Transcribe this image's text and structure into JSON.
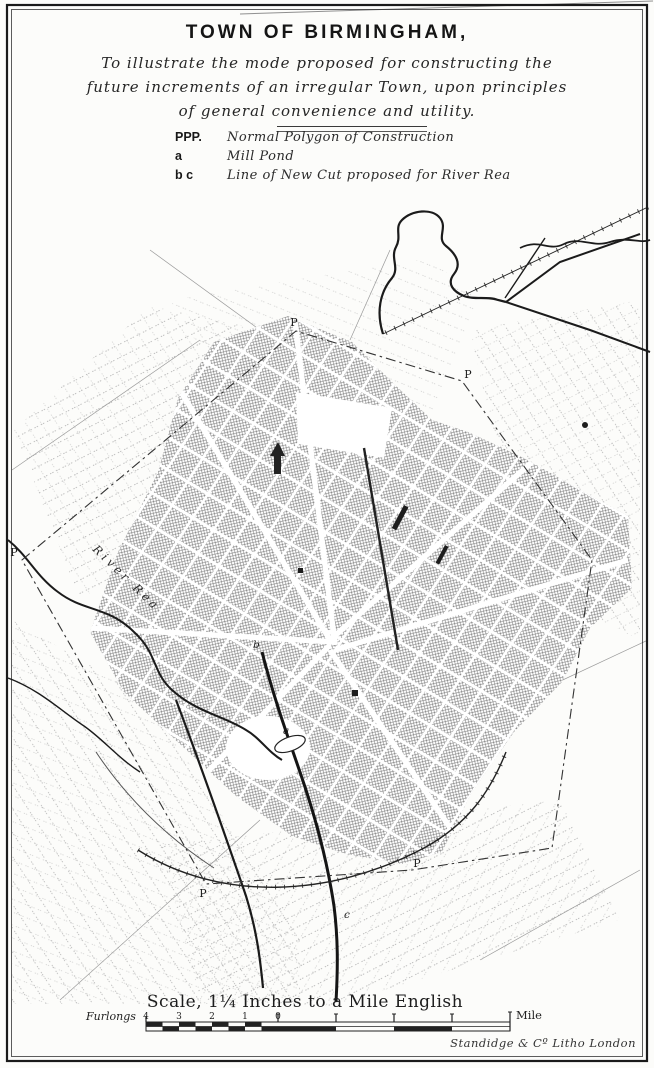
{
  "title_block": {
    "title": "TOWN OF BIRMINGHAM,",
    "subtitle_lines": [
      "To illustrate the mode proposed for constructing the",
      "future increments of an irregular Town, upon principles",
      "of general convenience and utility."
    ]
  },
  "legend": {
    "items": [
      {
        "key": "PPP.",
        "label": "Normal Polygon of Construction"
      },
      {
        "key": "a",
        "label": "Mill Pond"
      },
      {
        "key": "b c",
        "label": "Line of New Cut proposed for River Rea"
      }
    ]
  },
  "map": {
    "labels": {
      "river": "River Rea",
      "p": "P",
      "a": "a",
      "b": "b",
      "c": "c"
    }
  },
  "scale": {
    "caption": "Scale, 1¼ Inches to a Mile English",
    "furlongs_label": "Furlongs",
    "furlong_ticks": [
      "4",
      "3",
      "2",
      "1",
      "0"
    ],
    "mile_label": "Mile"
  },
  "imprint": "Standidge & Cº Litho London",
  "colors": {
    "paper": "#fcfcfa",
    "ink": "#1c1c1c",
    "hatch": "#767676",
    "faint_grid": "#b3b3b3"
  }
}
